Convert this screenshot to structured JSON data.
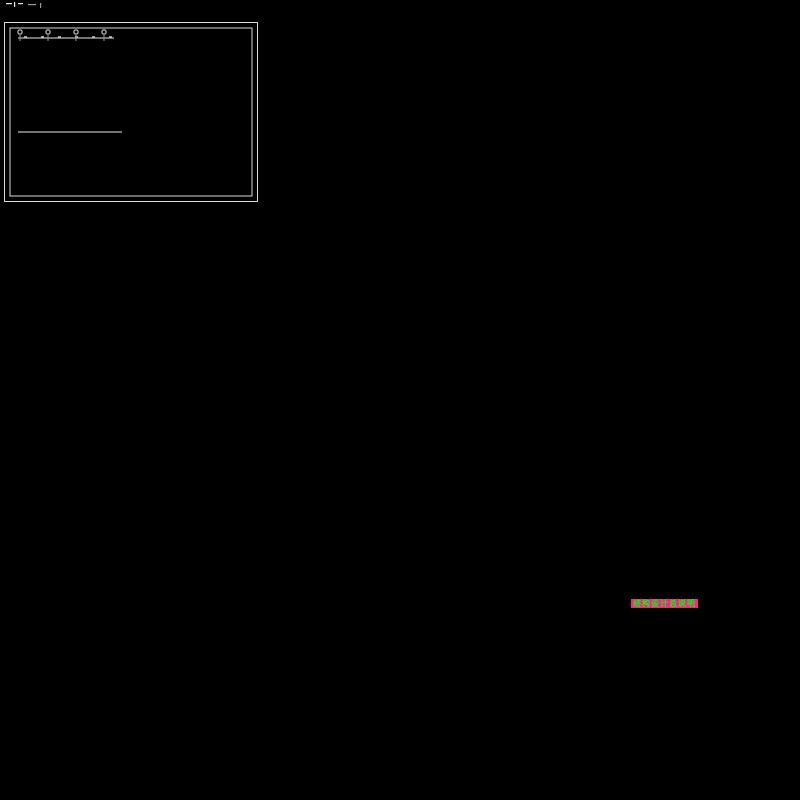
{
  "window": {
    "background": "#000000"
  },
  "grid": {
    "rows": 4,
    "columns": 3,
    "sheet_count": 12
  },
  "palette": {
    "background": "#000000",
    "sheet_border_white": "#d9d9d9",
    "beam_cyan": "#00ffff",
    "rebar_red": "#ff0000",
    "column_yellow": "#ffff00",
    "dimension_white": "#e8e8e8",
    "dimension_gray": "#9a9a9a",
    "notes_green": "#00ff00",
    "titleblock_magenta": "#ff1f8f"
  },
  "sheets": [
    {
      "id": "r1c1",
      "name": "foundation-plan-and-footing-details"
    },
    {
      "id": "r1c2",
      "name": "floor-plan-and-joint-details"
    },
    {
      "id": "r1c3",
      "name": "stair-and-wall-section-details"
    },
    {
      "id": "r2c1",
      "name": "slab-reinforcement-plan-a"
    },
    {
      "id": "r2c2",
      "name": "slab-reinforcement-plan-b"
    },
    {
      "id": "r2c3",
      "name": "beam-layout-plan"
    },
    {
      "id": "r3c1",
      "name": "paired-floor-framing-plans"
    },
    {
      "id": "r3c2",
      "name": "roof-beam-layout-plan"
    },
    {
      "id": "r3c3",
      "name": "column-elevations-and-joint-details"
    },
    {
      "id": "r4c1",
      "name": "paired-framing-plans-with-column-detail"
    },
    {
      "id": "r4c2",
      "name": "beam-elevations-and-notes"
    },
    {
      "id": "r4c3",
      "name": "structural-general-notes"
    }
  ],
  "notes_sheet": {
    "title": "结构设计总说明"
  }
}
